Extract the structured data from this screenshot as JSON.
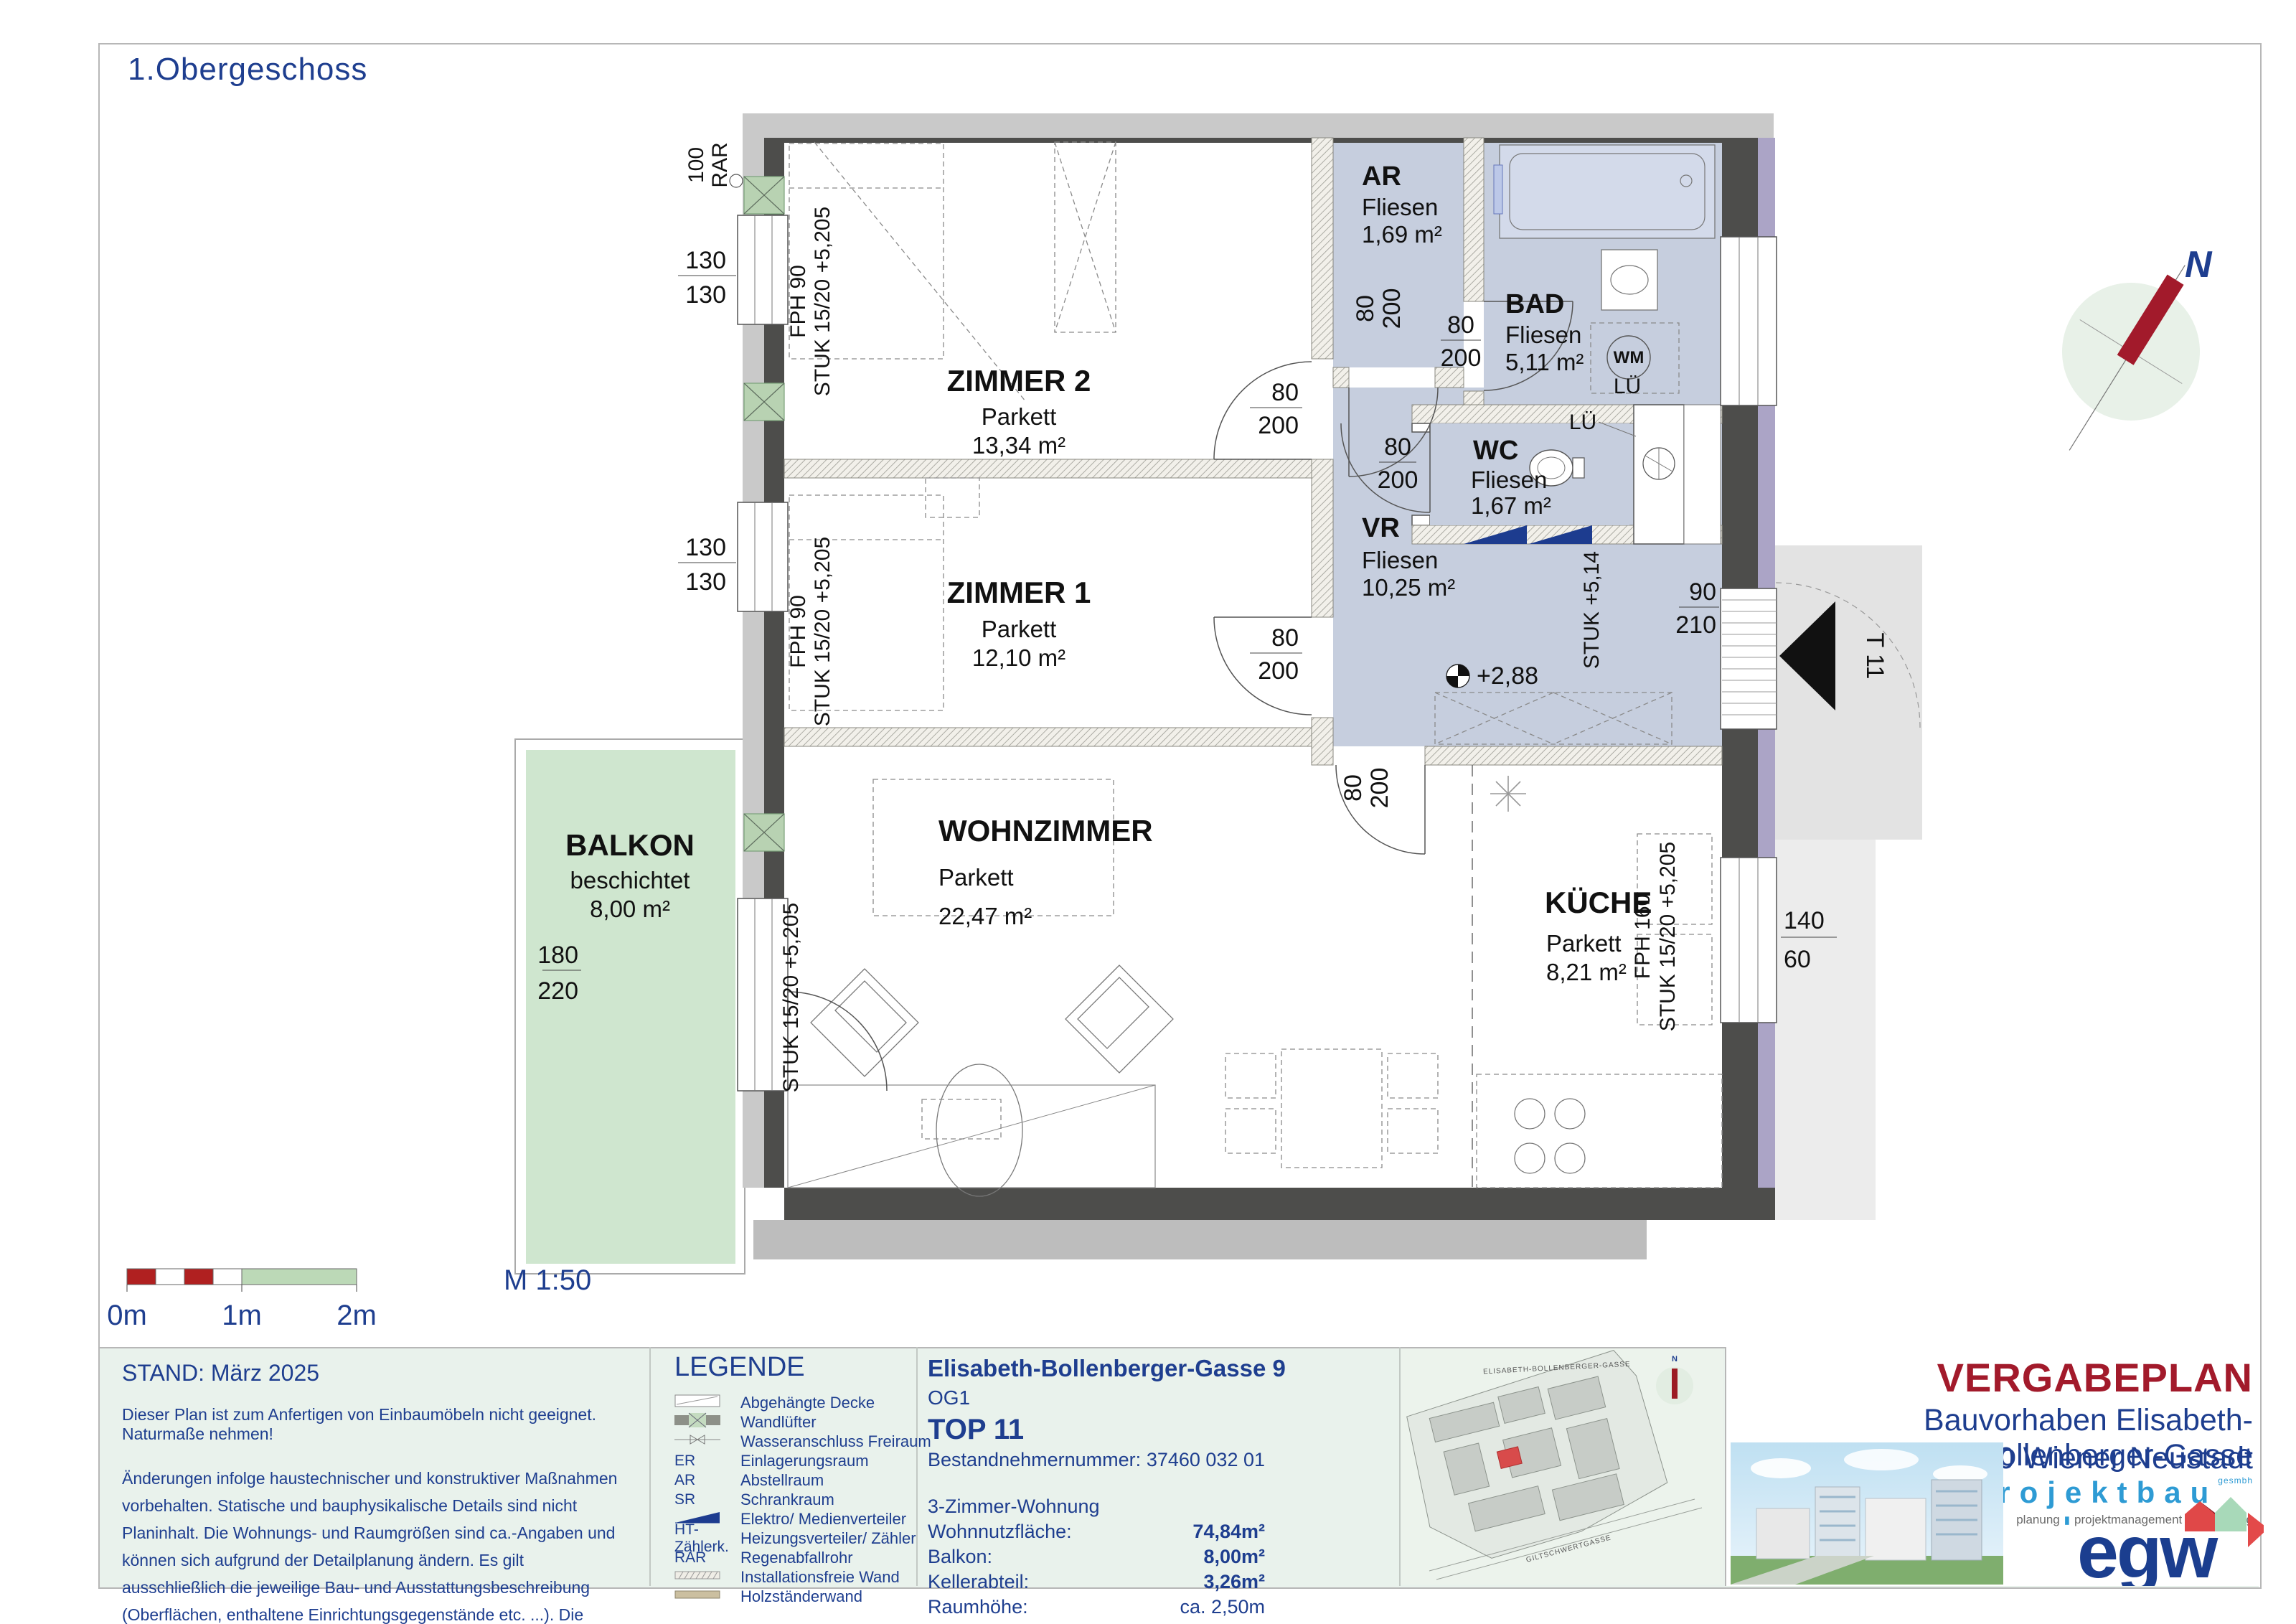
{
  "page": {
    "title": "1.Obergeschoss",
    "scale_label": "M 1:50",
    "scale_ticks": [
      "0m",
      "1m",
      "2m"
    ],
    "compass_n": "N"
  },
  "plan": {
    "rooms": {
      "zimmer2": {
        "name": "ZIMMER 2",
        "finish": "Parkett",
        "area": "13,34 m²"
      },
      "zimmer1": {
        "name": "ZIMMER 1",
        "finish": "Parkett",
        "area": "12,10 m²"
      },
      "ar": {
        "name": "AR",
        "finish": "Fliesen",
        "area": "1,69 m²"
      },
      "bad": {
        "name": "BAD",
        "finish": "Fliesen",
        "area": "5,11 m²"
      },
      "wc": {
        "name": "WC",
        "finish": "Fliesen",
        "area": "1,67 m²"
      },
      "vr": {
        "name": "VR",
        "finish": "Fliesen",
        "area": "10,25 m²"
      },
      "wohnzimmer": {
        "name": "WOHNZIMMER",
        "finish": "Parkett",
        "area": "22,47 m²"
      },
      "kueche": {
        "name": "KÜCHE",
        "finish": "Parkett",
        "area": "8,21 m²"
      },
      "balkon": {
        "name": "BALKON",
        "finish": "beschichtet",
        "area": "8,00 m²"
      }
    },
    "dims": {
      "z2_window": {
        "a": "130",
        "b": "130"
      },
      "z1_window": {
        "a": "130",
        "b": "130"
      },
      "z2_door": {
        "a": "80",
        "b": "200"
      },
      "z1_door": {
        "a": "80",
        "b": "200"
      },
      "ar_door": {
        "a": "80",
        "b": "200"
      },
      "bad_door": {
        "a": "80",
        "b": "200"
      },
      "wc_door": {
        "a": "80",
        "b": "200"
      },
      "vr_door": {
        "a": "80",
        "b": "200"
      },
      "entry_door": {
        "a": "90",
        "b": "210"
      },
      "balkon_door": {
        "a": "180",
        "b": "220"
      },
      "kueche_window": {
        "a": "140",
        "b": "60"
      }
    },
    "annotations": {
      "rar": "RAR",
      "rar_val": "100",
      "fph90": "FPH 90",
      "fph160": "FPH 160",
      "stuk": "STUK 15/20 +5,205",
      "stuk_entry": "STUK +5,14",
      "level": "+2,88",
      "door_tag": "T 11",
      "lu": "LÜ",
      "wm": "WM"
    }
  },
  "notes": {
    "stand": "STAND: März 2025",
    "note1": "Dieser Plan ist zum Anfertigen von Einbaumöbeln nicht geeignet. Naturmaße nehmen!",
    "note2": "Änderungen infolge haustechnischer und konstruktiver Maßnahmen vorbehalten. Statische und bauphysikalische Details sind nicht Planinhalt. Die Wohnungs- und Raumgrößen sind ca.-Angaben und können sich aufgrund der Detailplanung ändern. Es gilt ausschließlich die jeweilige Bau- und Ausstattungsbeschreibung (Oberflächen, enthaltene Einrichtungsgegenstände etc. ...). Die strichliert dargestellte Möblierung dient lediglich als Einrichtungsvorschlag."
  },
  "legend": {
    "title": "LEGENDE",
    "items": [
      {
        "key": "",
        "label": "Abgehängte Decke"
      },
      {
        "key": "",
        "label": "Wandlüfter"
      },
      {
        "key": "",
        "label": "Wasseranschluss Freiraum"
      },
      {
        "key": "ER",
        "label": "Einlagerungsraum"
      },
      {
        "key": "AR",
        "label": "Abstellraum"
      },
      {
        "key": "SR",
        "label": "Schrankraum"
      },
      {
        "key": "",
        "label": "Elektro/ Medienverteiler"
      },
      {
        "key": "HT-Zählerk.",
        "label": "Heizungsverteiler/ Zähler"
      },
      {
        "key": "RAR",
        "label": "Regenabfallrohr"
      },
      {
        "key": "",
        "label": "Installationsfreie Wand"
      },
      {
        "key": "",
        "label": "Holzständerwand"
      }
    ]
  },
  "info": {
    "address": "Elisabeth-Bollenberger-Gasse 9",
    "floor": "OG1",
    "top": "TOP 11",
    "tenant_label": "Bestandnehmernummer:",
    "tenant_value": "37460 032 01",
    "type": "3-Zimmer-Wohnung",
    "rows": [
      {
        "label": "Wohnnutzfläche:",
        "value": "74,84m²"
      },
      {
        "label": "Balkon:",
        "value": "8,00m²"
      },
      {
        "label": "Kellerabteil:",
        "value": "3,26m²"
      },
      {
        "label": "Raumhöhe:",
        "value": "ca. 2,50m"
      }
    ]
  },
  "sitemap": {
    "street1": "ELISABETH-BOLLENBERGER-GASSE",
    "street2": "GILTSCHWERTGASSE",
    "compass_n": "N"
  },
  "titleblock": {
    "heading": "VERGABEPLAN",
    "line1": "Bauvorhaben Elisabeth-Bollenberger-Gasse",
    "line2": "2700 Wiener Neustadt",
    "brand": "projektbau",
    "brand_suffix": "gesmbh",
    "services": [
      "planung",
      "projektmanagement",
      "bauleitung"
    ],
    "logo": "egw"
  },
  "colors": {
    "navy": "#1e3e8f",
    "plan_blue": "#c6cede",
    "balkon_green": "#cfe6cf",
    "dark_wall": "#4d4d4b",
    "light_wall": "#c9c9c9",
    "purple": "#aba4c6",
    "vergabe_red": "#a21a2b",
    "brand_blue": "#2e9bd4"
  }
}
